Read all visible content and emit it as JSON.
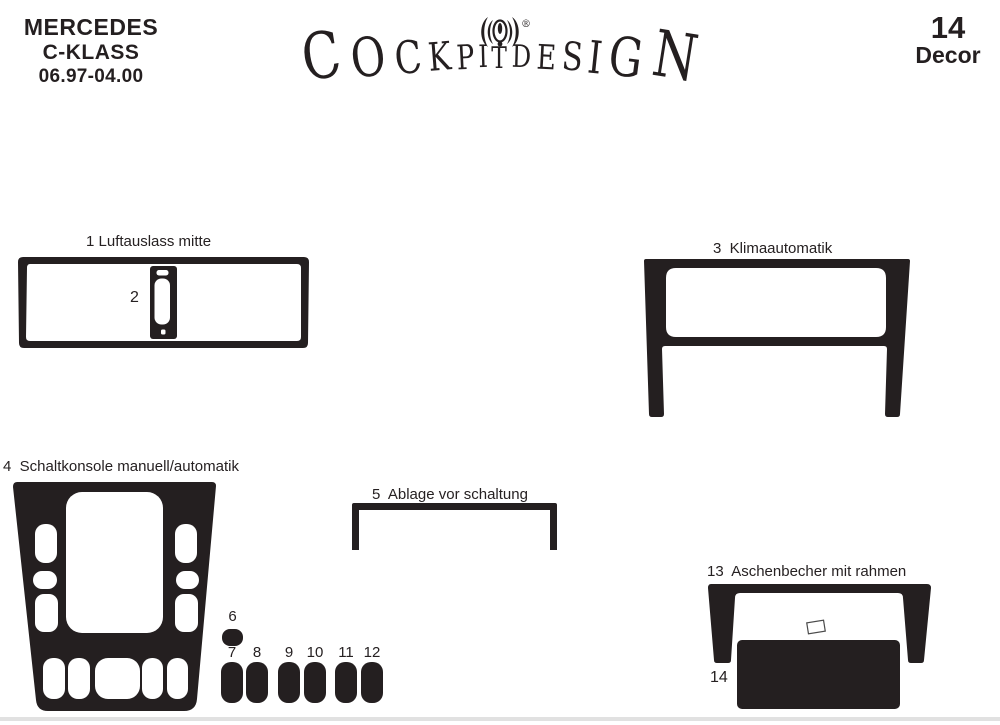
{
  "header": {
    "brand_line1": "MERCEDES",
    "brand_line2": "C-KLASS",
    "brand_line3": "06.97-04.00",
    "decor_count": "14",
    "decor_word": "Decor"
  },
  "logo": {
    "text": "COCKPITDESIGN",
    "registered": "®"
  },
  "labels": {
    "l1": "1 Luftauslass mitte",
    "l2": "2",
    "l3": "3  Klimaautomatik",
    "l4": "4  Schaltkonsole manuell/automatik",
    "l5": "5  Ablage vor schaltung",
    "l6": "6",
    "l7": "7",
    "l8": "8",
    "l9": "9",
    "l10": "10",
    "l11": "11",
    "l12": "12",
    "l13": "13  Aschenbecher mit rahmen",
    "l14": "14"
  },
  "pieces": [
    {
      "num": "1",
      "name": "Luftauslass mitte"
    },
    {
      "num": "2",
      "name": ""
    },
    {
      "num": "3",
      "name": "Klimaautomatik"
    },
    {
      "num": "4",
      "name": "Schaltkonsole manuell/automatik"
    },
    {
      "num": "5",
      "name": "Ablage vor schaltung"
    },
    {
      "num": "6",
      "name": ""
    },
    {
      "num": "7",
      "name": ""
    },
    {
      "num": "8",
      "name": ""
    },
    {
      "num": "9",
      "name": ""
    },
    {
      "num": "10",
      "name": ""
    },
    {
      "num": "11",
      "name": ""
    },
    {
      "num": "12",
      "name": ""
    },
    {
      "num": "13",
      "name": "Aschenbecher mit rahmen"
    },
    {
      "num": "14",
      "name": ""
    }
  ],
  "colors": {
    "ink": "#241f20",
    "background": "#ffffff"
  }
}
